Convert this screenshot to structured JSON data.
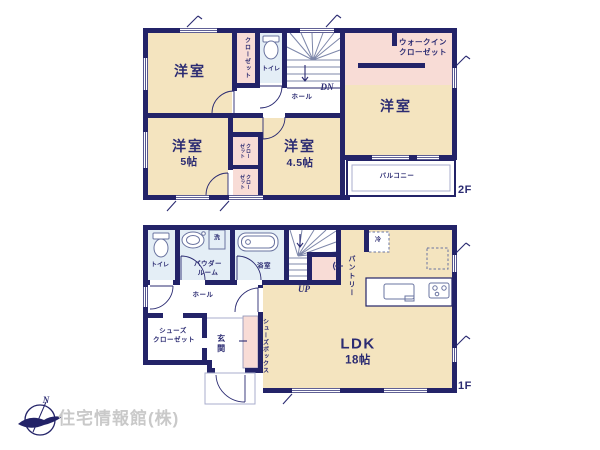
{
  "floor2": {
    "floor_label": "2F",
    "room_west1": "洋室",
    "closet_top": "クローゼット",
    "toilet": "トイレ",
    "stairs_dn": "DN",
    "hall": "ホール",
    "wic_line1": "ウォークイン",
    "wic_line2": "クローゼット",
    "room_west2": "洋室",
    "room_west3": "洋室",
    "room_west3_size": "5帖",
    "closet_mid_upper": "クローゼット",
    "closet_mid_lower": "クローゼット",
    "room_west4": "洋室",
    "room_west4_size": "4.5帖",
    "balcony": "バルコニー"
  },
  "floor1": {
    "floor_label": "1F",
    "toilet": "トイレ",
    "powder_line1": "パウダー",
    "powder_line2": "ルーム",
    "laundry": "洗",
    "bath": "浴室",
    "stairs_up": "UP",
    "pantry": "パントリー",
    "fridge": "冷",
    "hall": "ホール",
    "shoes_closet_line1": "シューズ",
    "shoes_closet_line2": "クローゼット",
    "entrance": "玄関",
    "shoes_box": "シューズボックス",
    "ldk": "LDK",
    "ldk_size": "18帖"
  },
  "footer": {
    "company": "住宅情報館(株)",
    "compass_north": "N"
  },
  "colors": {
    "wall": "#232368",
    "room": "#f4e4bf",
    "closet": "#f8dcd6",
    "wet": "#e4eef6",
    "text": "#2b2b72",
    "line": "#7d87aa",
    "logo": "#c9c9c9"
  }
}
